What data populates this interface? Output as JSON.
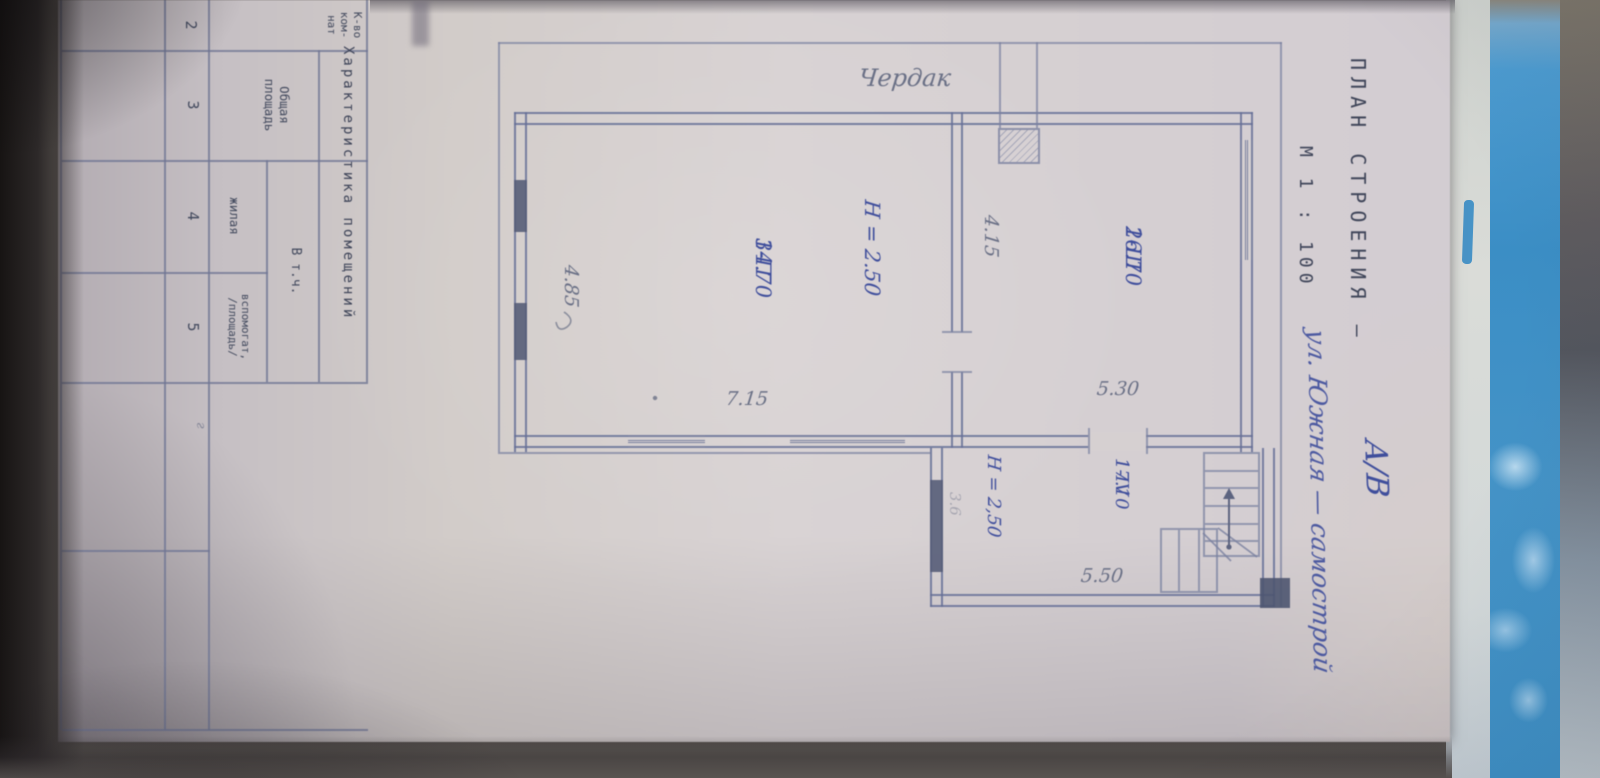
{
  "photo": {
    "colors": {
      "paper": "#d6d0d1",
      "drawing_line": "#7a81a0",
      "wall_line": "#667097",
      "typed_text": "#3f4559",
      "ink_blue": "#3f4e9c",
      "pencil_grey": "#6a7086",
      "folder_blue": "#3f94c9"
    }
  },
  "title": {
    "typed": "ПЛАН СТРОЕНИЯ —",
    "number": "А/В",
    "scale": "М 1 : 100",
    "annotation": "ул. Южная — самострой"
  },
  "plan": {
    "attic_label": "Чердак",
    "rooms": [
      {
        "id": "1-П",
        "area": "34.70",
        "height": "Н = 2.50"
      },
      {
        "id": "1-Ш",
        "area": "26.70"
      },
      {
        "id": "1-IV",
        "area": "17.10",
        "height": "Н = 2,50"
      }
    ],
    "dimensions": {
      "main_right": "7.15",
      "main_bottom": "4.85",
      "inner": "4.15",
      "room3_right": "5.30",
      "ext_right": "5.50",
      "ext_faint": "3.6"
    }
  },
  "table": {
    "title": "Характеристика помещений",
    "columns": {
      "rooms_lines": [
        "К-во",
        "ком-",
        "нат"
      ],
      "total_lines": [
        "Общая",
        "площадь"
      ],
      "including": "В т.ч.",
      "living": "жилая",
      "aux_lines": [
        "вспомогат,",
        "/площадь/"
      ]
    },
    "numbers": [
      "2",
      "3",
      "4",
      "5"
    ],
    "extra_mark": "г"
  }
}
